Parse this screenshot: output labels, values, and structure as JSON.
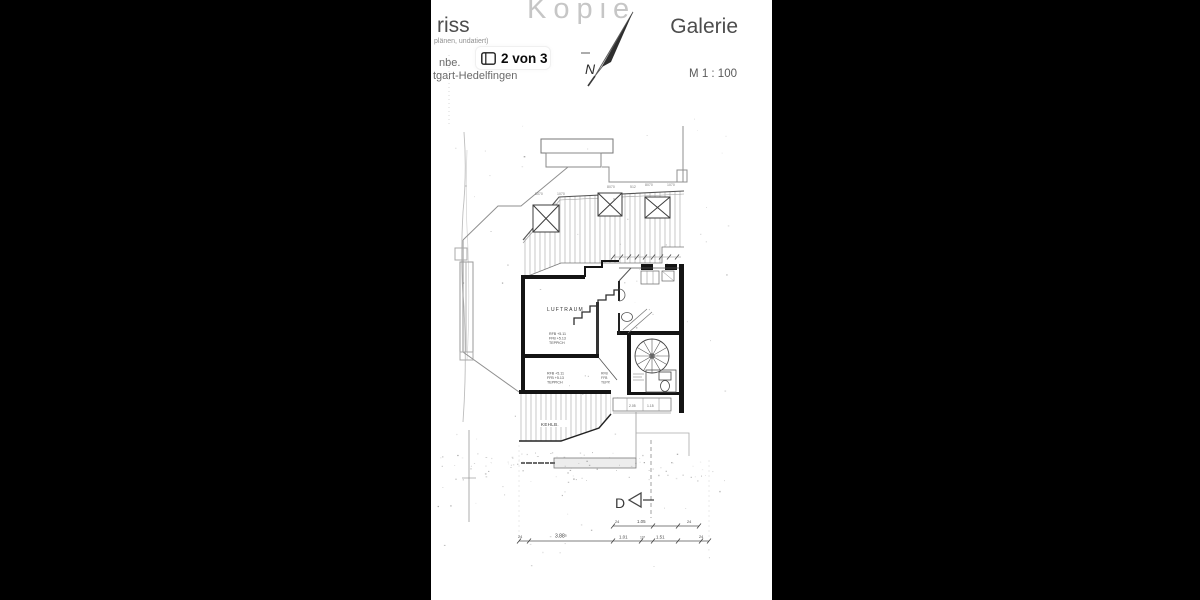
{
  "page": {
    "background": "#000000",
    "paper_color": "#ffffff"
  },
  "watermark": "Kopie",
  "header": {
    "title_fragment": "riss",
    "subtitle_fragment": "plänen, undatiert)",
    "line_fragment": "nbe.",
    "pager": "2 von 3",
    "location_fragment": "tgart-Hedelfingen",
    "sheet_title": "Galerie",
    "scale": "M 1 : 100",
    "north_label": "N"
  },
  "plan": {
    "void_label": "LUFTRAUM",
    "collar_label": "KEHLB.",
    "section_marker": "D",
    "level_block_1": [
      "RFB +5.11",
      "FFB +5.13",
      "TEPPICH"
    ],
    "level_block_2": [
      "RFB +5.11",
      "FFB +5.13",
      "TEPPICH"
    ],
    "level_block_3": [
      "RFB",
      "FFB",
      "TEPP."
    ],
    "dims_top": [
      "8070",
      "1070",
      "8070",
      "512",
      "8070",
      "1070"
    ],
    "dims_upper_row": [
      "24",
      "1.05",
      "24"
    ],
    "dims_bottom": [
      "24",
      "3.88⁵",
      "1.01",
      "10⁵",
      "1.51",
      "24"
    ],
    "dims_window_row": [
      "2.05",
      "1.15"
    ]
  }
}
